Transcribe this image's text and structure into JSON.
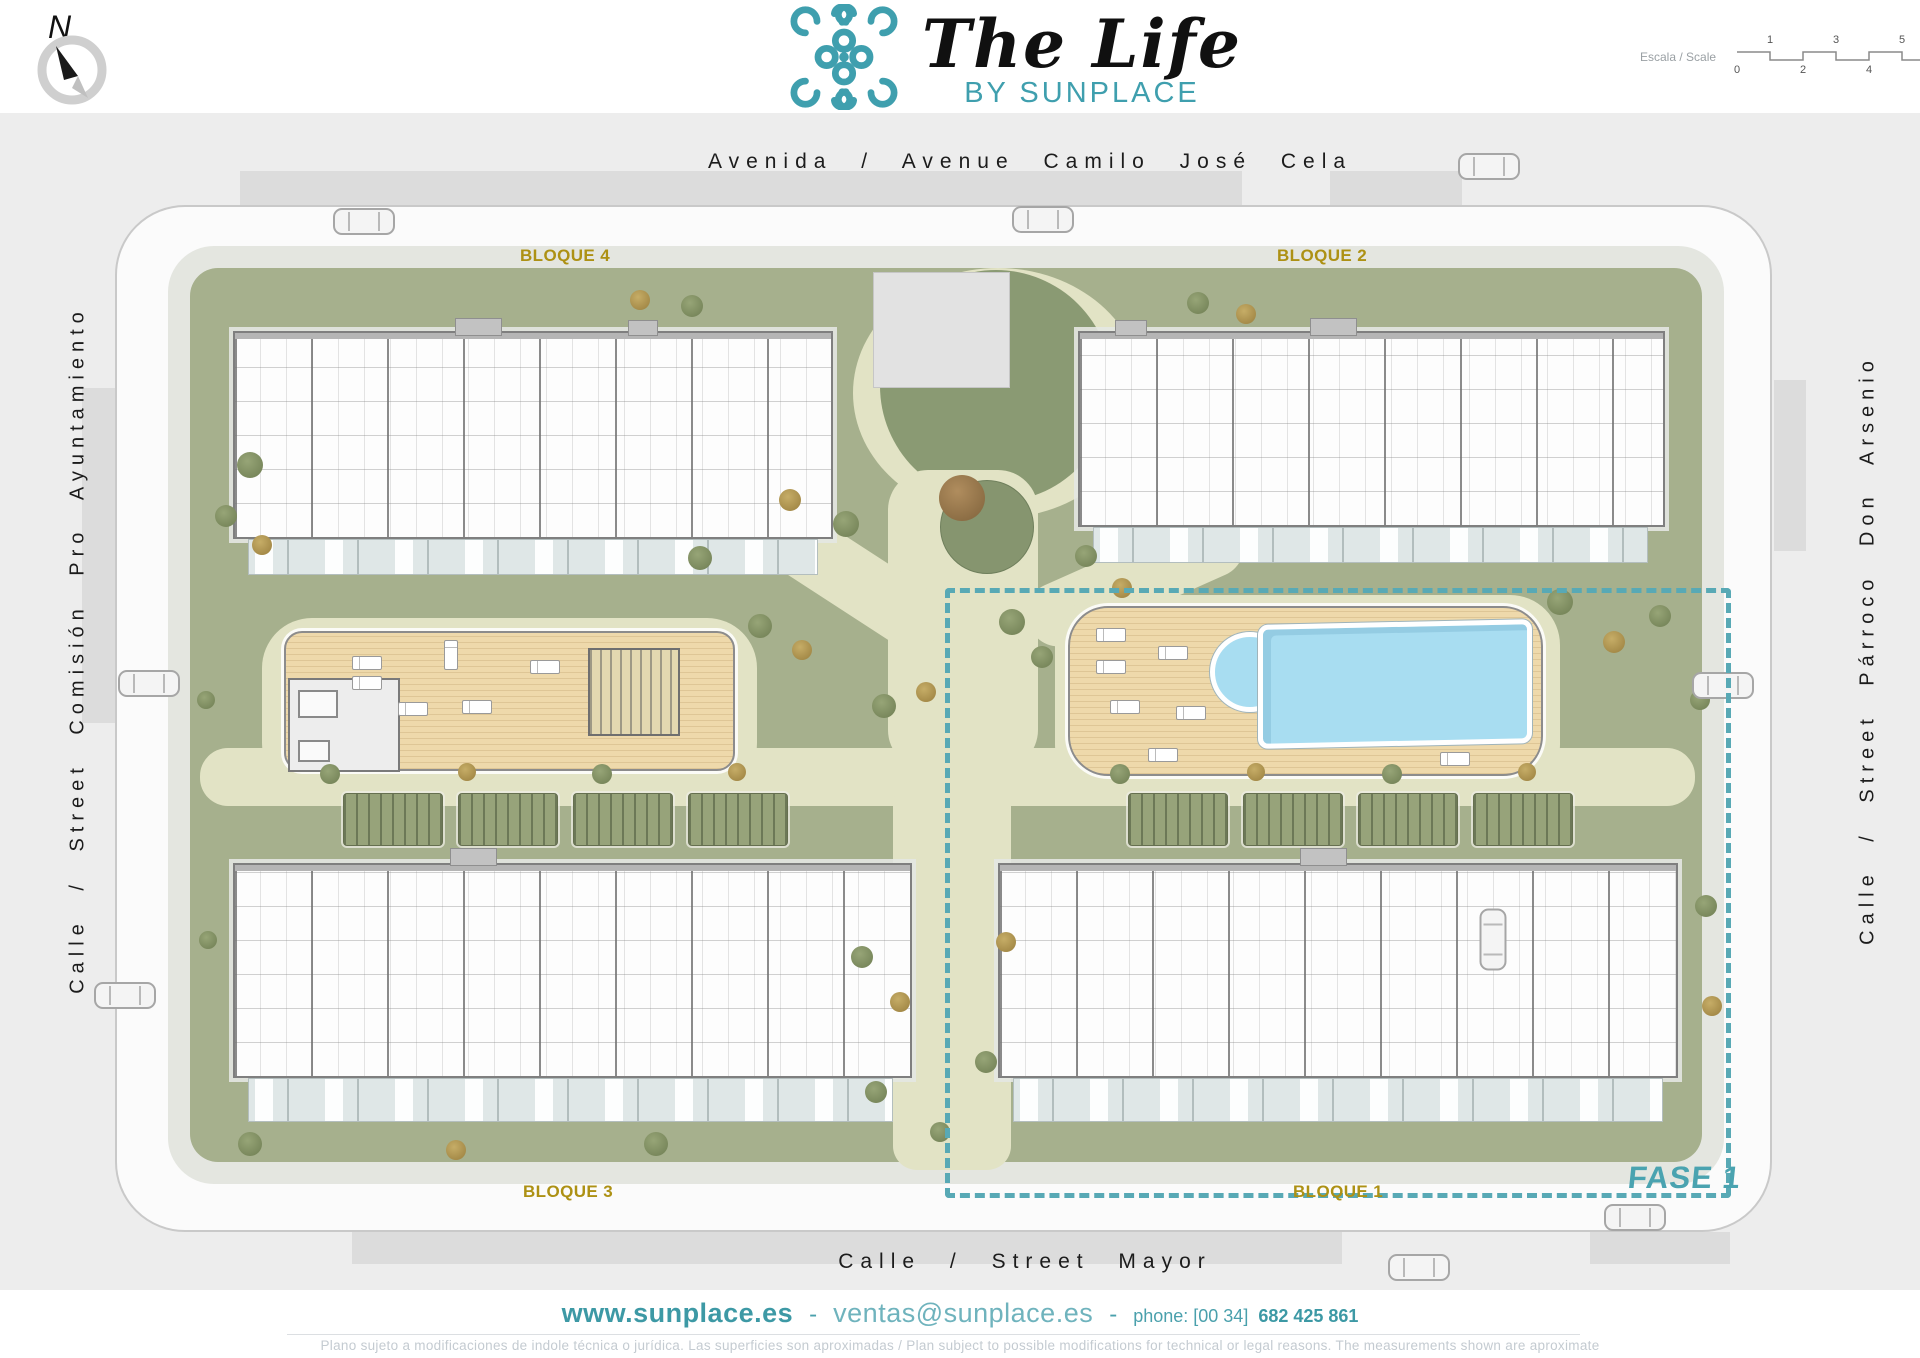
{
  "header": {
    "compass_n": "N",
    "logo_title": "The Life",
    "logo_subtitle": "BY SUNPLACE",
    "scale_label": "Escala / Scale",
    "scale_ticks_top": [
      "1",
      "3",
      "5"
    ],
    "scale_ticks_bottom": [
      "0",
      "2",
      "4",
      "6"
    ]
  },
  "streets": {
    "top": "Avenida / Avenue Camilo José Cela",
    "left": "Calle / Street Comisión Pro Ayuntamiento",
    "right": "Calle / Street Párroco Don Arsenio",
    "bottom": "Calle / Street Mayor"
  },
  "plan": {
    "blocks": [
      {
        "id": "bloque-1",
        "label": "BLOQUE 1"
      },
      {
        "id": "bloque-2",
        "label": "BLOQUE 2"
      },
      {
        "id": "bloque-3",
        "label": "BLOQUE 3"
      },
      {
        "id": "bloque-4",
        "label": "BLOQUE 4"
      }
    ],
    "phase_label": "FASE 1",
    "features": {
      "pool": "swimming-pool",
      "pool_deck": "wooden-sun-deck",
      "spa_deck": "wooden-deck-with-gym-pavilion",
      "plaza": "entrance-plaza",
      "playground": "playground-circle",
      "parking": "covered-parking-rows"
    }
  },
  "footer": {
    "website": "www.sunplace.es",
    "separator": "-",
    "email": "ventas@sunplace.es",
    "phone_label": "phone: [00 34]",
    "phone_number": "682 425 861",
    "disclaimer": "Plano sujeto a modificaciones de indole técnica o jurídica. Las superficies son aproximadas / Plan subject to possible modifications for technical or legal reasons. The measurements shown are aproximate"
  },
  "colors": {
    "brand_teal": "#3f9fae",
    "phase_teal": "#58a9b5",
    "block_gold": "#ad9114",
    "street_gray": "#ededed",
    "green_base": "#a6b08d",
    "green_dark": "#8a9a73",
    "path_cream": "#e2e3c5",
    "deck_wood": "#eed9ab",
    "pool_blue": "#a8ddf1"
  },
  "icons": {
    "logo": "sunplace-logo-knot-icon",
    "compass": "compass-north-icon",
    "tree": "tree-icon",
    "car": "car-icon",
    "lounger": "sun-lounger-icon"
  }
}
